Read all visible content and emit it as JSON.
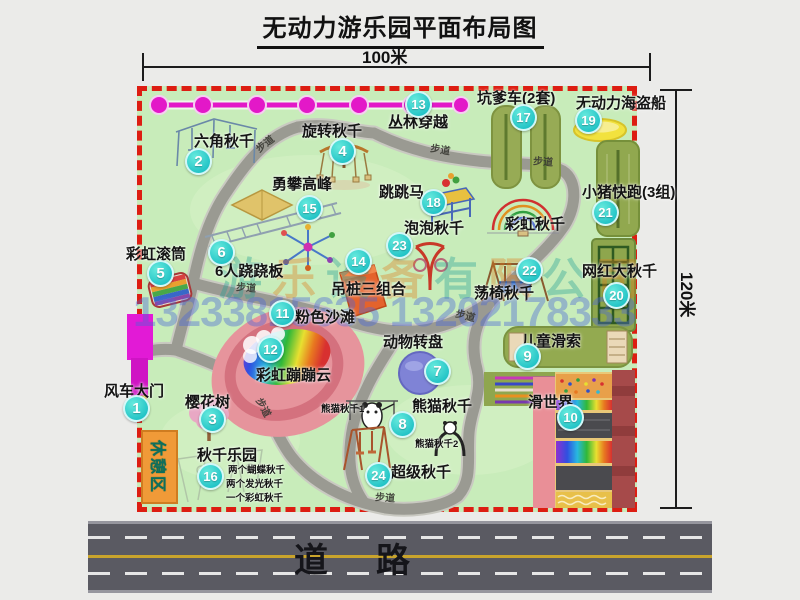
{
  "title": "无动力游乐园平面布局图",
  "dimensions": {
    "width": "100米",
    "height": "120米"
  },
  "road": {
    "label": "道路"
  },
  "watermark": {
    "company": "游乐设备有限公司",
    "phone": "13233815635 13202178333"
  },
  "rest_area": "休憩区",
  "path_label": "步道",
  "rainbow_swing_label": "彩虹秋千",
  "panda_sub_labels": [
    "熊猫秋千1",
    "熊猫秋千2"
  ],
  "swing_park_details": [
    "两个蝴蝶秋千",
    "两个发光秋千",
    "一个彩虹秋千"
  ],
  "colors": {
    "park_green": "#c8ecba",
    "border_red": "#dd1d12",
    "path_gray": "#9a9a92",
    "badge_teal": "#22c3c6",
    "gate_magenta": "#e21ad6",
    "rest_orange": "#f09a38",
    "road_gray": "#5a5a62",
    "beach_pink": "#e6949c"
  },
  "attractions": [
    {
      "num": 1,
      "label": "风车大门",
      "badge": [
        137,
        409
      ],
      "label_pos": [
        104,
        384
      ]
    },
    {
      "num": 2,
      "label": "六角秋千",
      "badge": [
        199,
        162
      ],
      "label_pos": [
        194,
        134
      ]
    },
    {
      "num": 3,
      "label": "樱花树",
      "badge": [
        213,
        420
      ],
      "label_pos": [
        185,
        395
      ]
    },
    {
      "num": 4,
      "label": "旋转秋千",
      "badge": [
        343,
        152
      ],
      "label_pos": [
        302,
        124
      ]
    },
    {
      "num": 5,
      "label": "彩虹滚筒",
      "badge": [
        161,
        274
      ],
      "label_pos": [
        126,
        247
      ]
    },
    {
      "num": 6,
      "label": "6人跷跷板",
      "badge": [
        222,
        253
      ],
      "label_pos": [
        215,
        264
      ]
    },
    {
      "num": 7,
      "label": "动物转盘",
      "badge": [
        438,
        372
      ],
      "label_pos": [
        383,
        335
      ]
    },
    {
      "num": 8,
      "label": "熊猫秋千",
      "badge": [
        403,
        425
      ],
      "label_pos": [
        412,
        399
      ]
    },
    {
      "num": 9,
      "label": "儿童滑索",
      "badge": [
        528,
        357
      ],
      "label_pos": [
        521,
        334
      ]
    },
    {
      "num": 10,
      "label": "滑世界",
      "badge": [
        571,
        418
      ],
      "label_pos": [
        528,
        395
      ]
    },
    {
      "num": 11,
      "label": "粉色沙滩",
      "badge": [
        283,
        314
      ],
      "label_pos": [
        295,
        310
      ]
    },
    {
      "num": 12,
      "label": "彩虹蹦蹦云",
      "badge": [
        271,
        350
      ],
      "label_pos": [
        256,
        368
      ]
    },
    {
      "num": 13,
      "label": "丛林穿越",
      "badge": [
        419,
        105
      ],
      "label_pos": [
        388,
        115
      ]
    },
    {
      "num": 14,
      "label": "吊桩三组合",
      "badge": [
        359,
        262
      ],
      "label_pos": [
        331,
        282
      ]
    },
    {
      "num": 15,
      "label": "勇攀高峰",
      "badge": [
        310,
        209
      ],
      "label_pos": [
        272,
        177
      ]
    },
    {
      "num": 16,
      "label": "秋千乐园",
      "badge": [
        211,
        477
      ],
      "label_pos": [
        197,
        448
      ]
    },
    {
      "num": 17,
      "label": "坑爹车(2套)",
      "badge": [
        524,
        118
      ],
      "label_pos": [
        477,
        91
      ]
    },
    {
      "num": 18,
      "label": "跳跳马",
      "badge": [
        434,
        203
      ],
      "label_pos": [
        379,
        185
      ]
    },
    {
      "num": 19,
      "label": "无动力海盗船",
      "badge": [
        589,
        121
      ],
      "label_pos": [
        576,
        96
      ]
    },
    {
      "num": 20,
      "label": "网红大秋千",
      "badge": [
        617,
        296
      ],
      "label_pos": [
        582,
        264
      ]
    },
    {
      "num": 21,
      "label": "小猪快跑(3组)",
      "badge": [
        606,
        213
      ],
      "label_pos": [
        582,
        185
      ]
    },
    {
      "num": 22,
      "label": "荡椅秋千",
      "badge": [
        530,
        271
      ],
      "label_pos": [
        474,
        286
      ]
    },
    {
      "num": 23,
      "label": "泡泡秋千",
      "badge": [
        400,
        246
      ],
      "label_pos": [
        404,
        221
      ]
    },
    {
      "num": 24,
      "label": "超级秋千",
      "badge": [
        379,
        476
      ],
      "label_pos": [
        391,
        465
      ]
    }
  ]
}
